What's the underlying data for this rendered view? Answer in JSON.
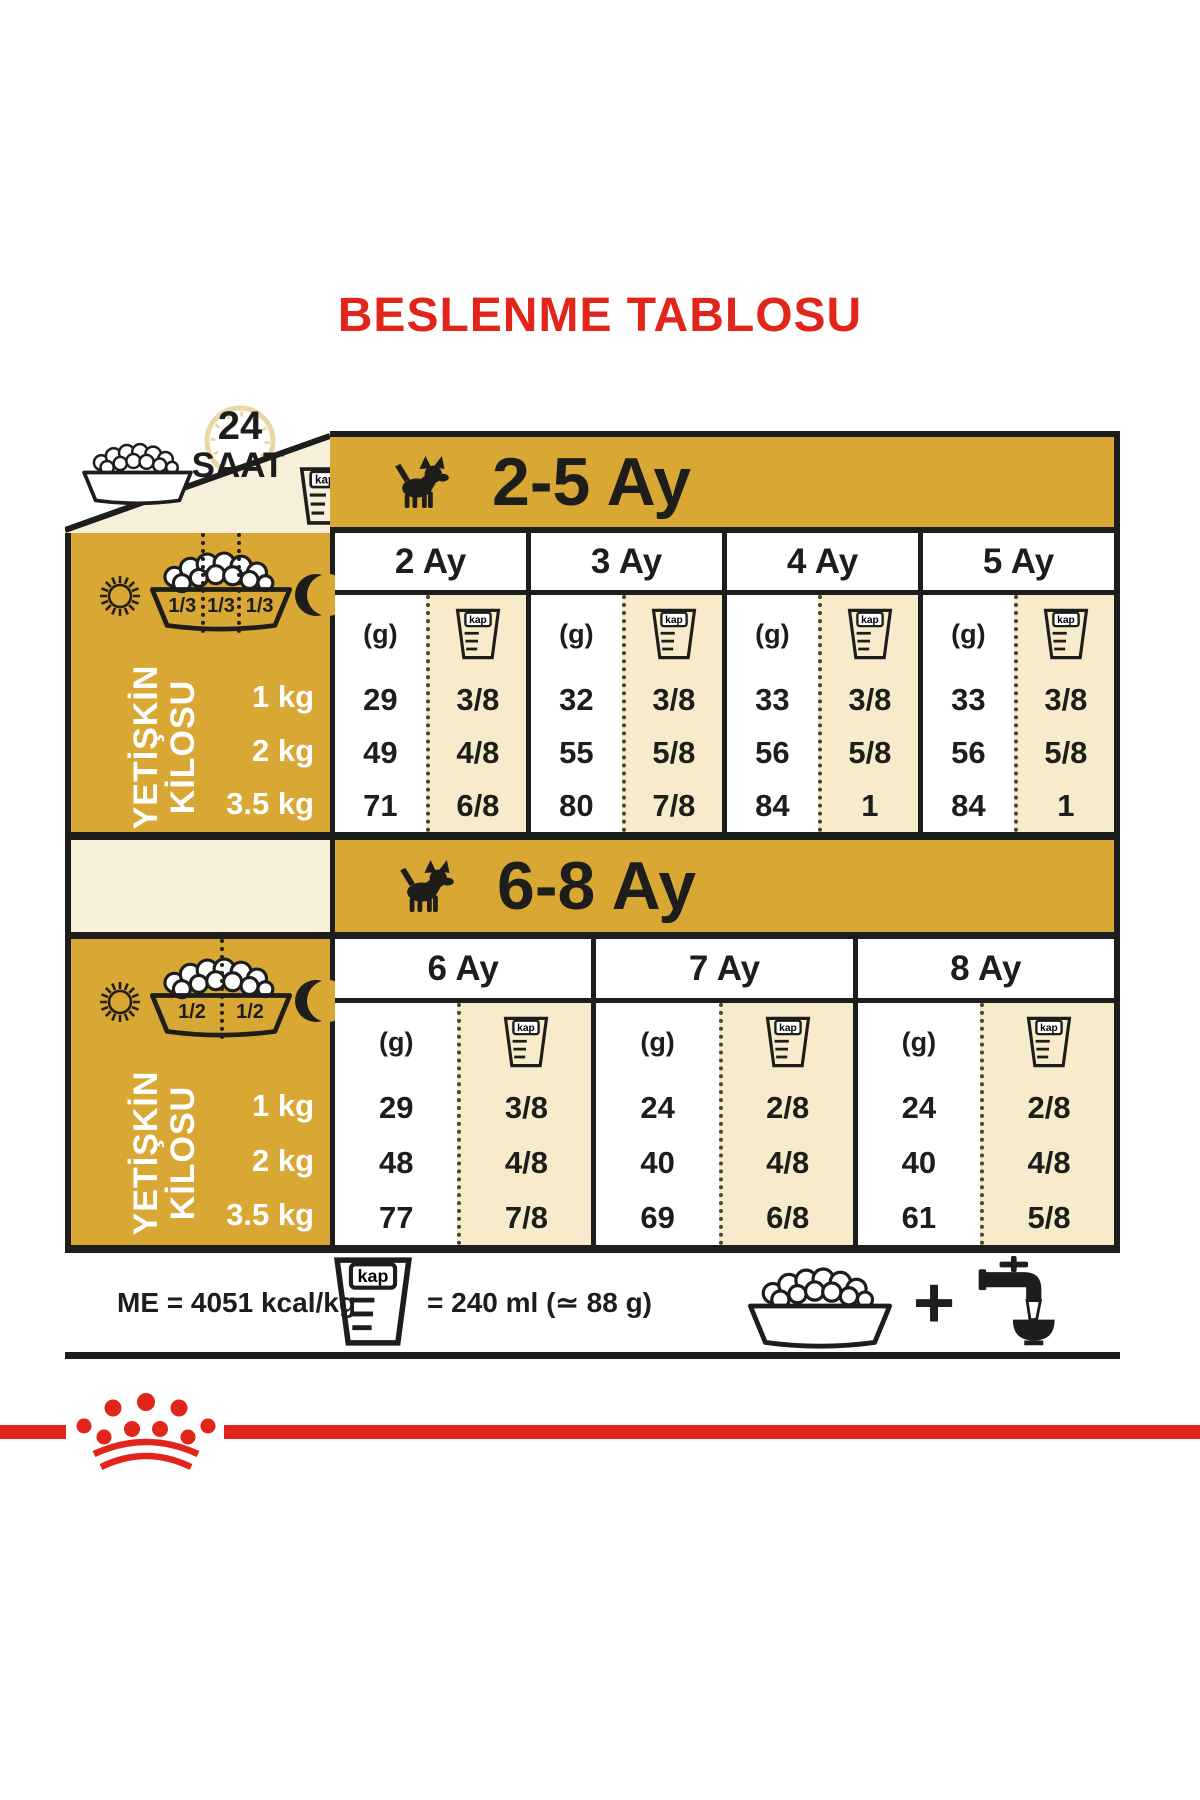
{
  "title": "BESLENME TABLOSU",
  "colors": {
    "gold": "#d9a733",
    "beige": "#f7ebcb",
    "cream": "#f7efda",
    "red": "#e1251b",
    "ink": "#1d1d1b"
  },
  "header": {
    "hours": "24",
    "saat": "SAAT"
  },
  "labels": {
    "kap": "kap",
    "g_unit": "(g)"
  },
  "sections": [
    {
      "title": "2-5 Ay",
      "fractions": [
        "1/3",
        "1/3",
        "1/3"
      ],
      "adult_weight_line1": "YETİŞKİN",
      "adult_weight_line2": "KİLOSU",
      "weights": [
        "1 kg",
        "2 kg",
        "3.5 kg"
      ],
      "months": [
        {
          "label": "2 Ay",
          "g": [
            "29",
            "49",
            "71"
          ],
          "kap": [
            "3/8",
            "4/8",
            "6/8"
          ]
        },
        {
          "label": "3 Ay",
          "g": [
            "32",
            "55",
            "80"
          ],
          "kap": [
            "3/8",
            "5/8",
            "7/8"
          ]
        },
        {
          "label": "4 Ay",
          "g": [
            "33",
            "56",
            "84"
          ],
          "kap": [
            "3/8",
            "5/8",
            "1"
          ]
        },
        {
          "label": "5 Ay",
          "g": [
            "33",
            "56",
            "84"
          ],
          "kap": [
            "3/8",
            "5/8",
            "1"
          ]
        }
      ]
    },
    {
      "title": "6-8 Ay",
      "fractions": [
        "1/2",
        "1/2"
      ],
      "adult_weight_line1": "YETİŞKİN",
      "adult_weight_line2": "KİLOSU",
      "weights": [
        "1 kg",
        "2 kg",
        "3.5 kg"
      ],
      "months": [
        {
          "label": "6 Ay",
          "g": [
            "29",
            "48",
            "77"
          ],
          "kap": [
            "3/8",
            "4/8",
            "7/8"
          ]
        },
        {
          "label": "7 Ay",
          "g": [
            "24",
            "40",
            "69"
          ],
          "kap": [
            "2/8",
            "4/8",
            "6/8"
          ]
        },
        {
          "label": "8 Ay",
          "g": [
            "24",
            "40",
            "61"
          ],
          "kap": [
            "2/8",
            "4/8",
            "5/8"
          ]
        }
      ]
    }
  ],
  "footer": {
    "me": "ME = 4051 kcal/kg",
    "cup_equiv": "= 240 ml (≃ 88 g)",
    "plus": "+"
  }
}
